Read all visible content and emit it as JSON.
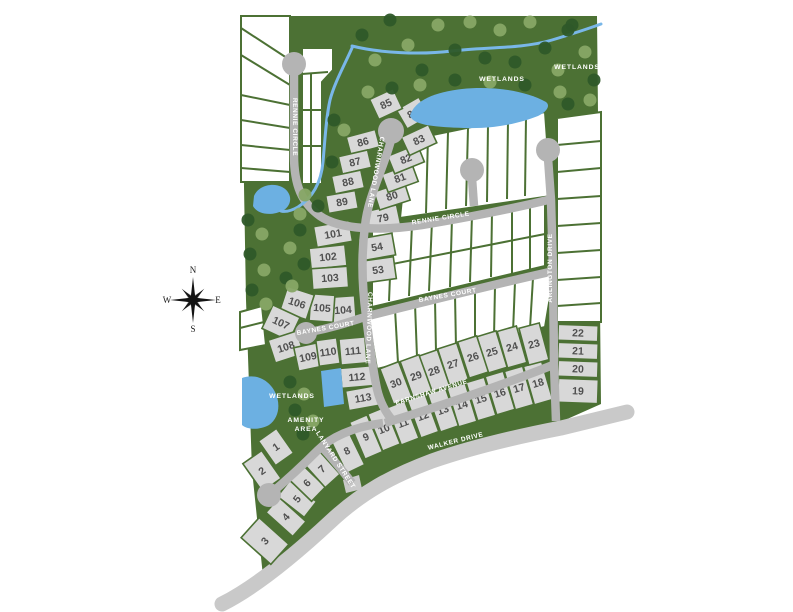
{
  "colors": {
    "green": "#4c7134",
    "tree_dark": "#2e5929",
    "tree_light": "#87a766",
    "road": "#b4b4b4",
    "road_outer": "#c9c9c9",
    "lot": "#d8d8d8",
    "water": "#6cb0e2",
    "stream": "#79b7e8",
    "number": "#4f4f4f",
    "label": "#ffffff"
  },
  "map": {
    "site": "241,16 597,16 601,404 556,424 470,448 386,481 330,518 264,586 252,470 246,300 241,16",
    "walker": {
      "d": "M222,604 C252,589 288,561 330,522 C362,492 392,476 432,461 C472,447 520,436 561,428 L627,412",
      "stub": "M343,480 L359,475 L362,489 L346,493 Z",
      "width": 15
    },
    "white_blocks": [
      "241,16 290,16 290,182 241,182",
      "302,48 333,48 333,70 322,82 322,184 302,184",
      "372,230 545,203 545,266 372,307",
      "408,140 545,112 551,196 400,218",
      "557,118 601,112 601,322 557,322",
      "368,315 554,273 545,327 377,369",
      "240,312 262,306 266,345 240,350"
    ],
    "dividers": [
      [
        241,
        28,
        290,
        60
      ],
      [
        241,
        55,
        290,
        85
      ],
      [
        241,
        95,
        290,
        105
      ],
      [
        241,
        120,
        290,
        128
      ],
      [
        241,
        145,
        290,
        150
      ],
      [
        241,
        168,
        290,
        172
      ],
      [
        302,
        74,
        328,
        72
      ],
      [
        311,
        74,
        311,
        184
      ],
      [
        302,
        110,
        322,
        110
      ],
      [
        302,
        146,
        322,
        146
      ],
      [
        372,
        268,
        545,
        234
      ],
      [
        392,
        227,
        389,
        301
      ],
      [
        412,
        224,
        409,
        296
      ],
      [
        432,
        221,
        429,
        291
      ],
      [
        452,
        218,
        450,
        287
      ],
      [
        472,
        215,
        470,
        282
      ],
      [
        492,
        212,
        491,
        277
      ],
      [
        512,
        209,
        512,
        273
      ],
      [
        530,
        206,
        530,
        269
      ],
      [
        428,
        136,
        426,
        213
      ],
      [
        448,
        132,
        446,
        209
      ],
      [
        468,
        128,
        466,
        206
      ],
      [
        488,
        124,
        487,
        202
      ],
      [
        508,
        120,
        507,
        199
      ],
      [
        526,
        117,
        525,
        196
      ],
      [
        557,
        145,
        601,
        141
      ],
      [
        557,
        172,
        601,
        168
      ],
      [
        557,
        199,
        601,
        196
      ],
      [
        557,
        226,
        601,
        223
      ],
      [
        557,
        253,
        601,
        250
      ],
      [
        557,
        280,
        601,
        277
      ],
      [
        557,
        306,
        601,
        303
      ],
      [
        395,
        309,
        398,
        363
      ],
      [
        415,
        304,
        417,
        357
      ],
      [
        435,
        300,
        436,
        352
      ],
      [
        455,
        295,
        456,
        347
      ],
      [
        475,
        291,
        475,
        342
      ],
      [
        495,
        286,
        494,
        337
      ],
      [
        515,
        282,
        513,
        332
      ],
      [
        533,
        278,
        530,
        328
      ],
      [
        240,
        328,
        264,
        322
      ]
    ],
    "roads": [
      {
        "id": "rennie-circle",
        "d": "M294,64 L294,155 C294,186 302,203 320,216 C340,230 382,231 422,225 C466,218 520,207 552,199",
        "w": 8.5
      },
      {
        "id": "charnwood-lane",
        "d": "M391,140 C384,168 368,196 365,226 C361,256 362,286 366,316 C370,346 372,366 377,389 C380,402 386,413 393,421",
        "w": 8.5
      },
      {
        "id": "arlington-drive",
        "d": "M548,158 L551,200 L553,270 L554,364 L556,421",
        "w": 8.5
      },
      {
        "id": "court-stub",
        "d": "M472,178 L474,206",
        "w": 8.5
      },
      {
        "id": "baynes-court",
        "d": "M310,332 C336,327 352,321 368,316 C420,303 500,283 554,271",
        "w": 8.5
      },
      {
        "id": "earnshaw-avenue",
        "d": "M385,423 C440,406 500,386 553,365",
        "w": 8.5
      },
      {
        "id": "lanyard-street",
        "d": "M269,495 C288,479 305,463 318,450 C330,438 352,427 383,423",
        "w": 8.5
      },
      {
        "id": "lanyard-spur",
        "d": "M322,447 C332,458 342,470 352,483",
        "w": 8.5
      }
    ],
    "culdesacs": [
      [
        294,
        64,
        12
      ],
      [
        391,
        131,
        13
      ],
      [
        548,
        150,
        12
      ],
      [
        472,
        170,
        12
      ],
      [
        306,
        333,
        11
      ],
      [
        269,
        495,
        12
      ]
    ],
    "water": {
      "streams": [
        "M352,46 C380,53 420,55 452,51 C484,47 522,49 552,40 C572,34 590,28 601,24",
        "M352,48 C344,66 334,84 330,100 C326,118 325,140 323,162 C321,184 312,198 298,207 C291,211 285,212 281,211"
      ],
      "ponds": [
        "M410,116 C414,100 436,92 462,89 C492,86 524,90 546,102 C551,106 546,112 538,116 C518,124 492,129 464,128 C438,127 414,126 410,116 Z",
        "M254,196 C258,186 272,182 282,187 C292,192 293,204 284,210 C271,217 257,214 253,206 Z",
        "M242,378 C256,373 269,380 275,392 C281,404 279,418 269,425 C258,431 246,429 242,425 Z",
        "M321,371 L341,368 L344,404 L324,407 Z"
      ]
    },
    "trees": [
      [
        362,
        35,
        0
      ],
      [
        375,
        60,
        1
      ],
      [
        390,
        20,
        0
      ],
      [
        408,
        45,
        1
      ],
      [
        422,
        70,
        0
      ],
      [
        438,
        25,
        1
      ],
      [
        455,
        50,
        0
      ],
      [
        470,
        22,
        1
      ],
      [
        485,
        58,
        0
      ],
      [
        500,
        30,
        1
      ],
      [
        515,
        62,
        0
      ],
      [
        530,
        22,
        1
      ],
      [
        545,
        48,
        0
      ],
      [
        558,
        70,
        1
      ],
      [
        572,
        25,
        0
      ],
      [
        585,
        52,
        1
      ],
      [
        594,
        80,
        0
      ],
      [
        560,
        92,
        1
      ],
      [
        525,
        85,
        0
      ],
      [
        490,
        82,
        1
      ],
      [
        455,
        80,
        0
      ],
      [
        420,
        85,
        1
      ],
      [
        392,
        88,
        0
      ],
      [
        368,
        92,
        1
      ],
      [
        568,
        30,
        0
      ],
      [
        590,
        100,
        1
      ],
      [
        568,
        104,
        0
      ],
      [
        334,
        120,
        0
      ],
      [
        344,
        130,
        1
      ],
      [
        332,
        162,
        0
      ],
      [
        305,
        195,
        1
      ],
      [
        318,
        206,
        0
      ],
      [
        300,
        214,
        1
      ],
      [
        248,
        220,
        0
      ],
      [
        262,
        234,
        1
      ],
      [
        250,
        254,
        0
      ],
      [
        264,
        270,
        1
      ],
      [
        252,
        290,
        0
      ],
      [
        266,
        304,
        1
      ],
      [
        286,
        278,
        0
      ],
      [
        300,
        230,
        0
      ],
      [
        290,
        248,
        1
      ],
      [
        304,
        264,
        0
      ],
      [
        292,
        286,
        1
      ],
      [
        290,
        382,
        0
      ],
      [
        304,
        394,
        1
      ],
      [
        295,
        410,
        0
      ],
      [
        313,
        421,
        1
      ],
      [
        303,
        434,
        0
      ]
    ]
  },
  "lots": [
    [
      1,
      276,
      447,
      22,
      30,
      -35
    ],
    [
      2,
      262,
      471,
      23,
      34,
      -35
    ],
    [
      3,
      265,
      541,
      27,
      40,
      -48
    ],
    [
      4,
      286,
      517,
      20,
      36,
      -48
    ],
    [
      5,
      297,
      499,
      20,
      34,
      -52
    ],
    [
      6,
      307,
      483,
      20,
      32,
      -46
    ],
    [
      7,
      322,
      469,
      20,
      32,
      -42
    ],
    [
      8,
      347,
      451,
      20,
      40,
      -26
    ],
    [
      9,
      366,
      437,
      19,
      40,
      -23
    ],
    [
      10,
      384,
      429,
      19,
      40,
      -22
    ],
    [
      11,
      403,
      423,
      19,
      40,
      -21
    ],
    [
      12,
      423,
      416,
      19,
      40,
      -20
    ],
    [
      13,
      443,
      410,
      19,
      40,
      -19
    ],
    [
      14,
      462,
      405,
      19,
      40,
      -17
    ],
    [
      15,
      481,
      399,
      19,
      40,
      -17
    ],
    [
      16,
      500,
      393,
      19,
      40,
      -17
    ],
    [
      17,
      519,
      388,
      19,
      40,
      -16
    ],
    [
      18,
      538,
      383,
      19,
      40,
      -16
    ],
    [
      19,
      578,
      391,
      40,
      24,
      2
    ],
    [
      20,
      578,
      369,
      40,
      16,
      2
    ],
    [
      21,
      578,
      351,
      40,
      16,
      2
    ],
    [
      22,
      578,
      333,
      40,
      16,
      2
    ],
    [
      23,
      534,
      344,
      21,
      38,
      -15
    ],
    [
      24,
      512,
      347,
      20,
      38,
      -16
    ],
    [
      25,
      492,
      352,
      20,
      38,
      -17
    ],
    [
      26,
      473,
      357,
      20,
      38,
      -18
    ],
    [
      27,
      453,
      364,
      20,
      38,
      -18
    ],
    [
      28,
      434,
      371,
      20,
      38,
      -19
    ],
    [
      29,
      416,
      376,
      20,
      38,
      -20
    ],
    [
      30,
      396,
      383,
      20,
      38,
      -21
    ],
    [
      53,
      378,
      270,
      34,
      22,
      -8
    ],
    [
      54,
      377,
      247,
      34,
      22,
      -10
    ],
    [
      79,
      383,
      218,
      32,
      20,
      -12
    ],
    [
      80,
      392,
      196,
      32,
      19,
      -18
    ],
    [
      81,
      400,
      178,
      32,
      19,
      -20
    ],
    [
      82,
      406,
      159,
      32,
      19,
      -22
    ],
    [
      83,
      419,
      140,
      30,
      20,
      -25
    ],
    [
      84,
      413,
      113,
      26,
      22,
      -30
    ],
    [
      85,
      386,
      104,
      26,
      22,
      -25
    ],
    [
      86,
      363,
      142,
      30,
      18,
      -15
    ],
    [
      87,
      355,
      162,
      30,
      18,
      -13
    ],
    [
      88,
      348,
      182,
      30,
      18,
      -12
    ],
    [
      89,
      342,
      202,
      30,
      18,
      -10
    ],
    [
      101,
      333,
      234,
      36,
      21,
      -10
    ],
    [
      102,
      328,
      257,
      36,
      21,
      -6
    ],
    [
      103,
      330,
      278,
      36,
      21,
      -4
    ],
    [
      104,
      343,
      310,
      25,
      27,
      -4
    ],
    [
      105,
      322,
      308,
      24,
      27,
      4
    ],
    [
      106,
      297,
      303,
      28,
      26,
      18
    ],
    [
      107,
      281,
      323,
      30,
      26,
      25
    ],
    [
      108,
      286,
      347,
      30,
      24,
      -18
    ],
    [
      109,
      308,
      357,
      24,
      24,
      -12
    ],
    [
      110,
      328,
      352,
      21,
      26,
      -8
    ],
    [
      111,
      353,
      351,
      26,
      26,
      -5
    ],
    [
      112,
      357,
      377,
      32,
      20,
      -5
    ],
    [
      113,
      363,
      398,
      32,
      20,
      -10
    ]
  ],
  "streets": [
    {
      "name": "RENNIE CIRCLE",
      "x": 293,
      "y": 127,
      "rot": 90
    },
    {
      "name": "RENNIE CIRCLE",
      "x": 441,
      "y": 220,
      "rot": -9
    },
    {
      "name": "CHARNWOOD LANE",
      "x": 374,
      "y": 172,
      "rot": 100
    },
    {
      "name": "CHARNWOOD LANE",
      "x": 367,
      "y": 328,
      "rot": 92
    },
    {
      "name": "ARLINGTON DRIVE",
      "x": 552,
      "y": 268,
      "rot": -90
    },
    {
      "name": "BAYNES COURT",
      "x": 326,
      "y": 330,
      "rot": -10
    },
    {
      "name": "BAYNES COURT",
      "x": 448,
      "y": 297,
      "rot": -10
    },
    {
      "name": "EARNSHAW AVENUE",
      "x": 432,
      "y": 394,
      "rot": -17
    },
    {
      "name": "WALKER DRIVE",
      "x": 456,
      "y": 443,
      "rot": -14
    },
    {
      "name": "LANYARD STREET",
      "x": 334,
      "y": 461,
      "rot": 57
    }
  ],
  "area_labels": [
    {
      "text": "WETLANDS",
      "x": 502,
      "y": 81
    },
    {
      "text": "WETLANDS",
      "x": 577,
      "y": 69
    },
    {
      "text": "WETLANDS",
      "x": 292,
      "y": 398
    },
    {
      "text": "AMENITY",
      "x": 306,
      "y": 422
    },
    {
      "text": "AREA",
      "x": 306,
      "y": 431
    }
  ],
  "compass": {
    "cx": 193,
    "cy": 300,
    "n": "N",
    "s": "S",
    "e": "E",
    "w": "W"
  }
}
